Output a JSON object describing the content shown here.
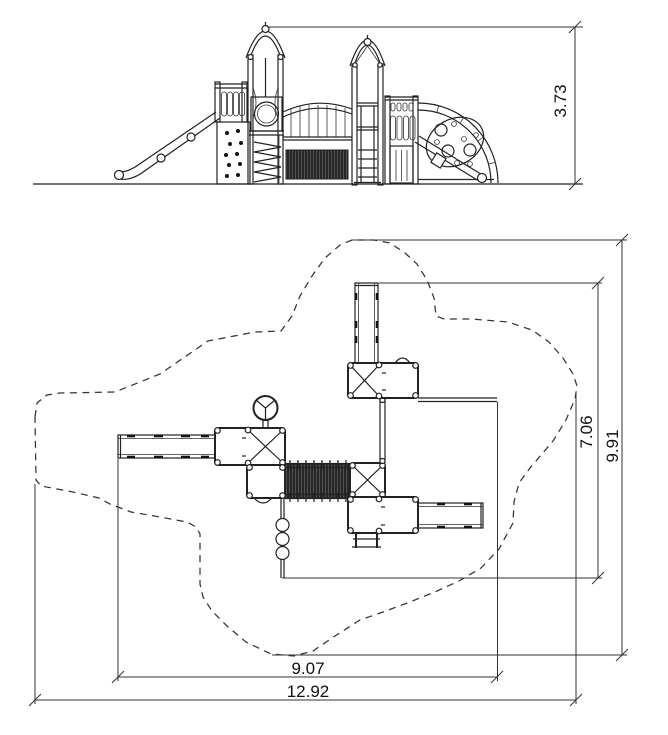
{
  "drawing": {
    "background": "#ffffff",
    "line_color": "#222222",
    "net_fill": "#262626",
    "elevation": {
      "height": "3.73"
    },
    "plan": {
      "structure_depth": "7.06",
      "use_zone_depth": "9.91",
      "structure_width": "9.07",
      "use_zone_width": "12.92"
    }
  }
}
